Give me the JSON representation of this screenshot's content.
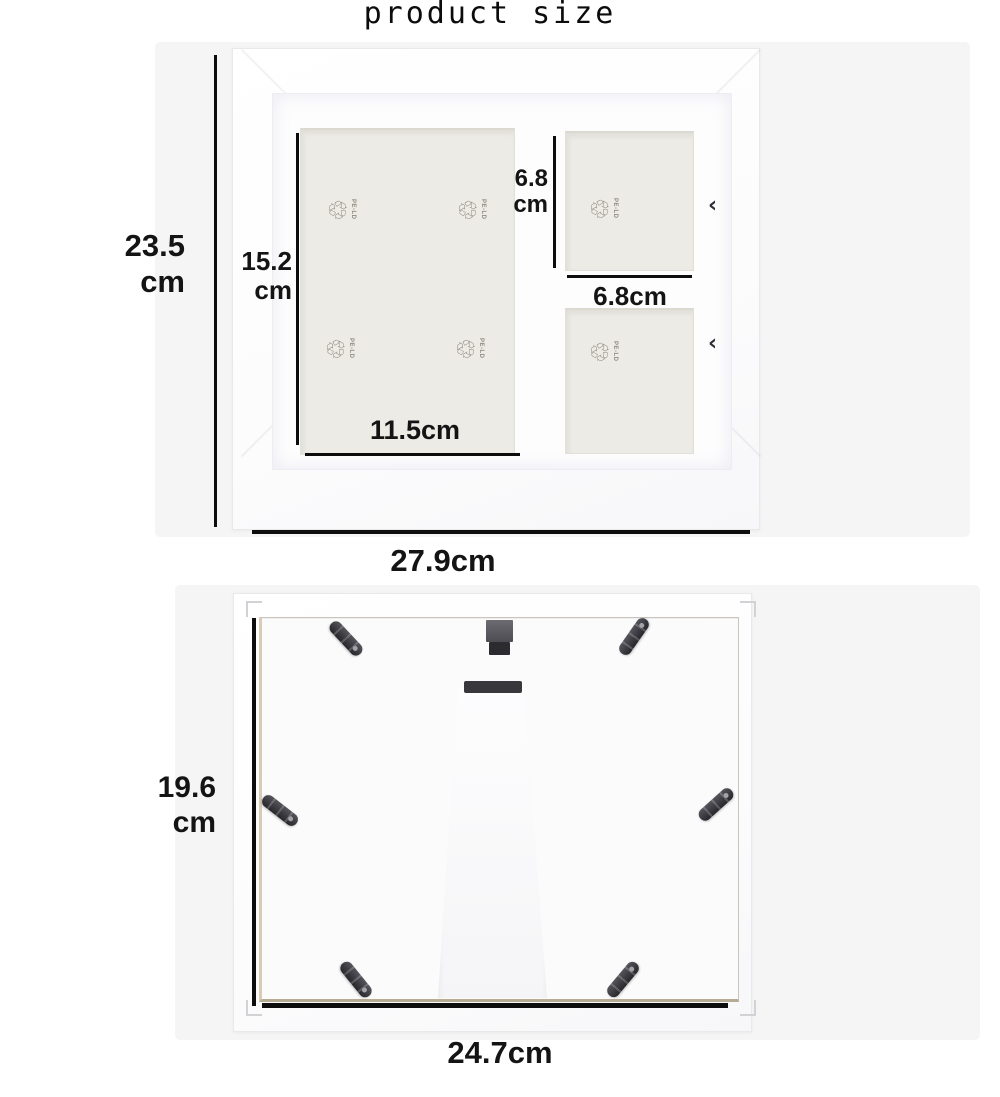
{
  "page": {
    "title": "product size"
  },
  "front_view": {
    "overall_height": {
      "value": "23.5",
      "unit": "cm"
    },
    "overall_width": {
      "label": "27.9cm"
    },
    "main_opening_height": {
      "value": "15.2",
      "unit": "cm"
    },
    "main_opening_width": {
      "label": "11.5cm"
    },
    "square_opening_height": {
      "value": "6.8",
      "unit": "cm"
    },
    "square_opening_width": {
      "label": "6.8cm"
    },
    "recycle": {
      "glyph": "♲",
      "label": "PE-LD"
    },
    "retainer_glyph": "‹"
  },
  "back_view": {
    "overall_height": {
      "value": "19.6",
      "unit": "cm"
    },
    "overall_width": {
      "label": "24.7cm"
    }
  },
  "colors": {
    "dimension_line": "#0d0d0d",
    "text": "#141414",
    "frame": "#ffffff",
    "mat": "#fdfdfe",
    "opening": "#edebe5",
    "panel": "#fbfbfc",
    "clip": "#3a3a3f",
    "backdrop": "#f6f5f5"
  }
}
